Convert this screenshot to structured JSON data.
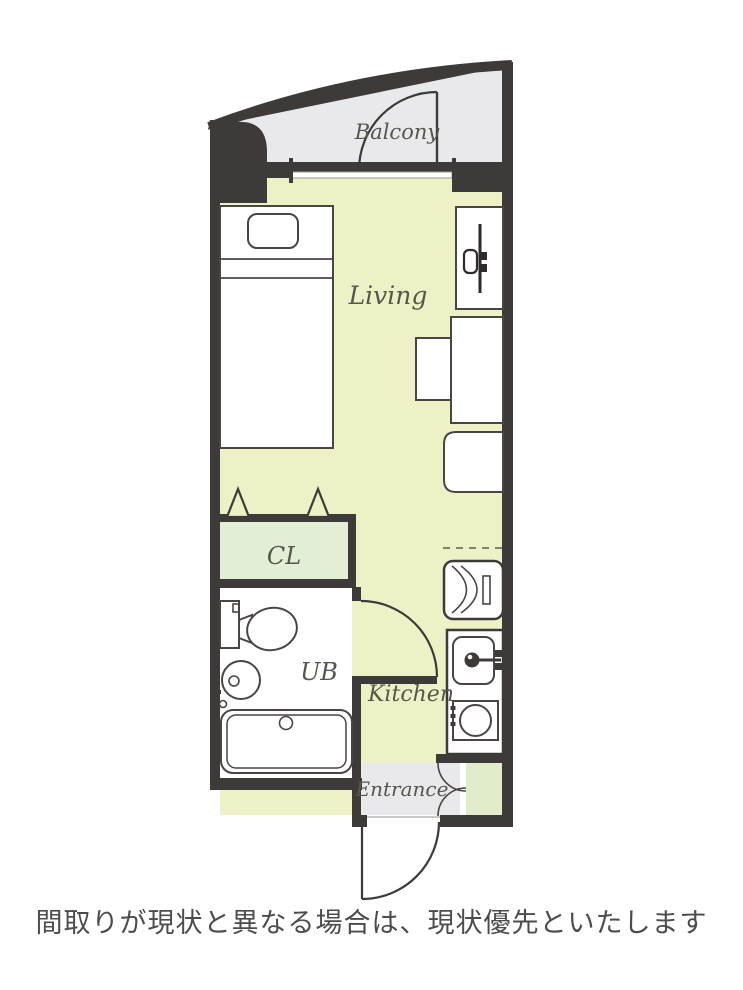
{
  "plan": {
    "rooms": {
      "balcony": {
        "label": "Balcony"
      },
      "living": {
        "label": "Living"
      },
      "closet": {
        "label": "CL"
      },
      "bath": {
        "label": "UB"
      },
      "kitchen": {
        "label": "Kitchen"
      },
      "entrance": {
        "label": "Entrance"
      }
    },
    "fixtures": [
      "bed",
      "pillow",
      "tv",
      "desk",
      "chair",
      "stool",
      "refrigerator",
      "kitchen-sink",
      "stove",
      "toilet",
      "washbasin",
      "bathtub",
      "shoe-cabinet"
    ],
    "colors": {
      "wall": "#3e3a39",
      "floor_living": "#eef1c5",
      "floor_closet": "#e3eed7",
      "floor_shoe_cabinet": "#e1edca",
      "floor_balcony_entrance": "#e9e9eb",
      "fixture_fill": "#ffffff",
      "fixture_stroke": "#4a4543",
      "label_text": "#56564e",
      "caption_text": "#4c4c4c"
    }
  },
  "caption": {
    "text": "間取りが現状と異なる場合は、現状優先といたします"
  }
}
